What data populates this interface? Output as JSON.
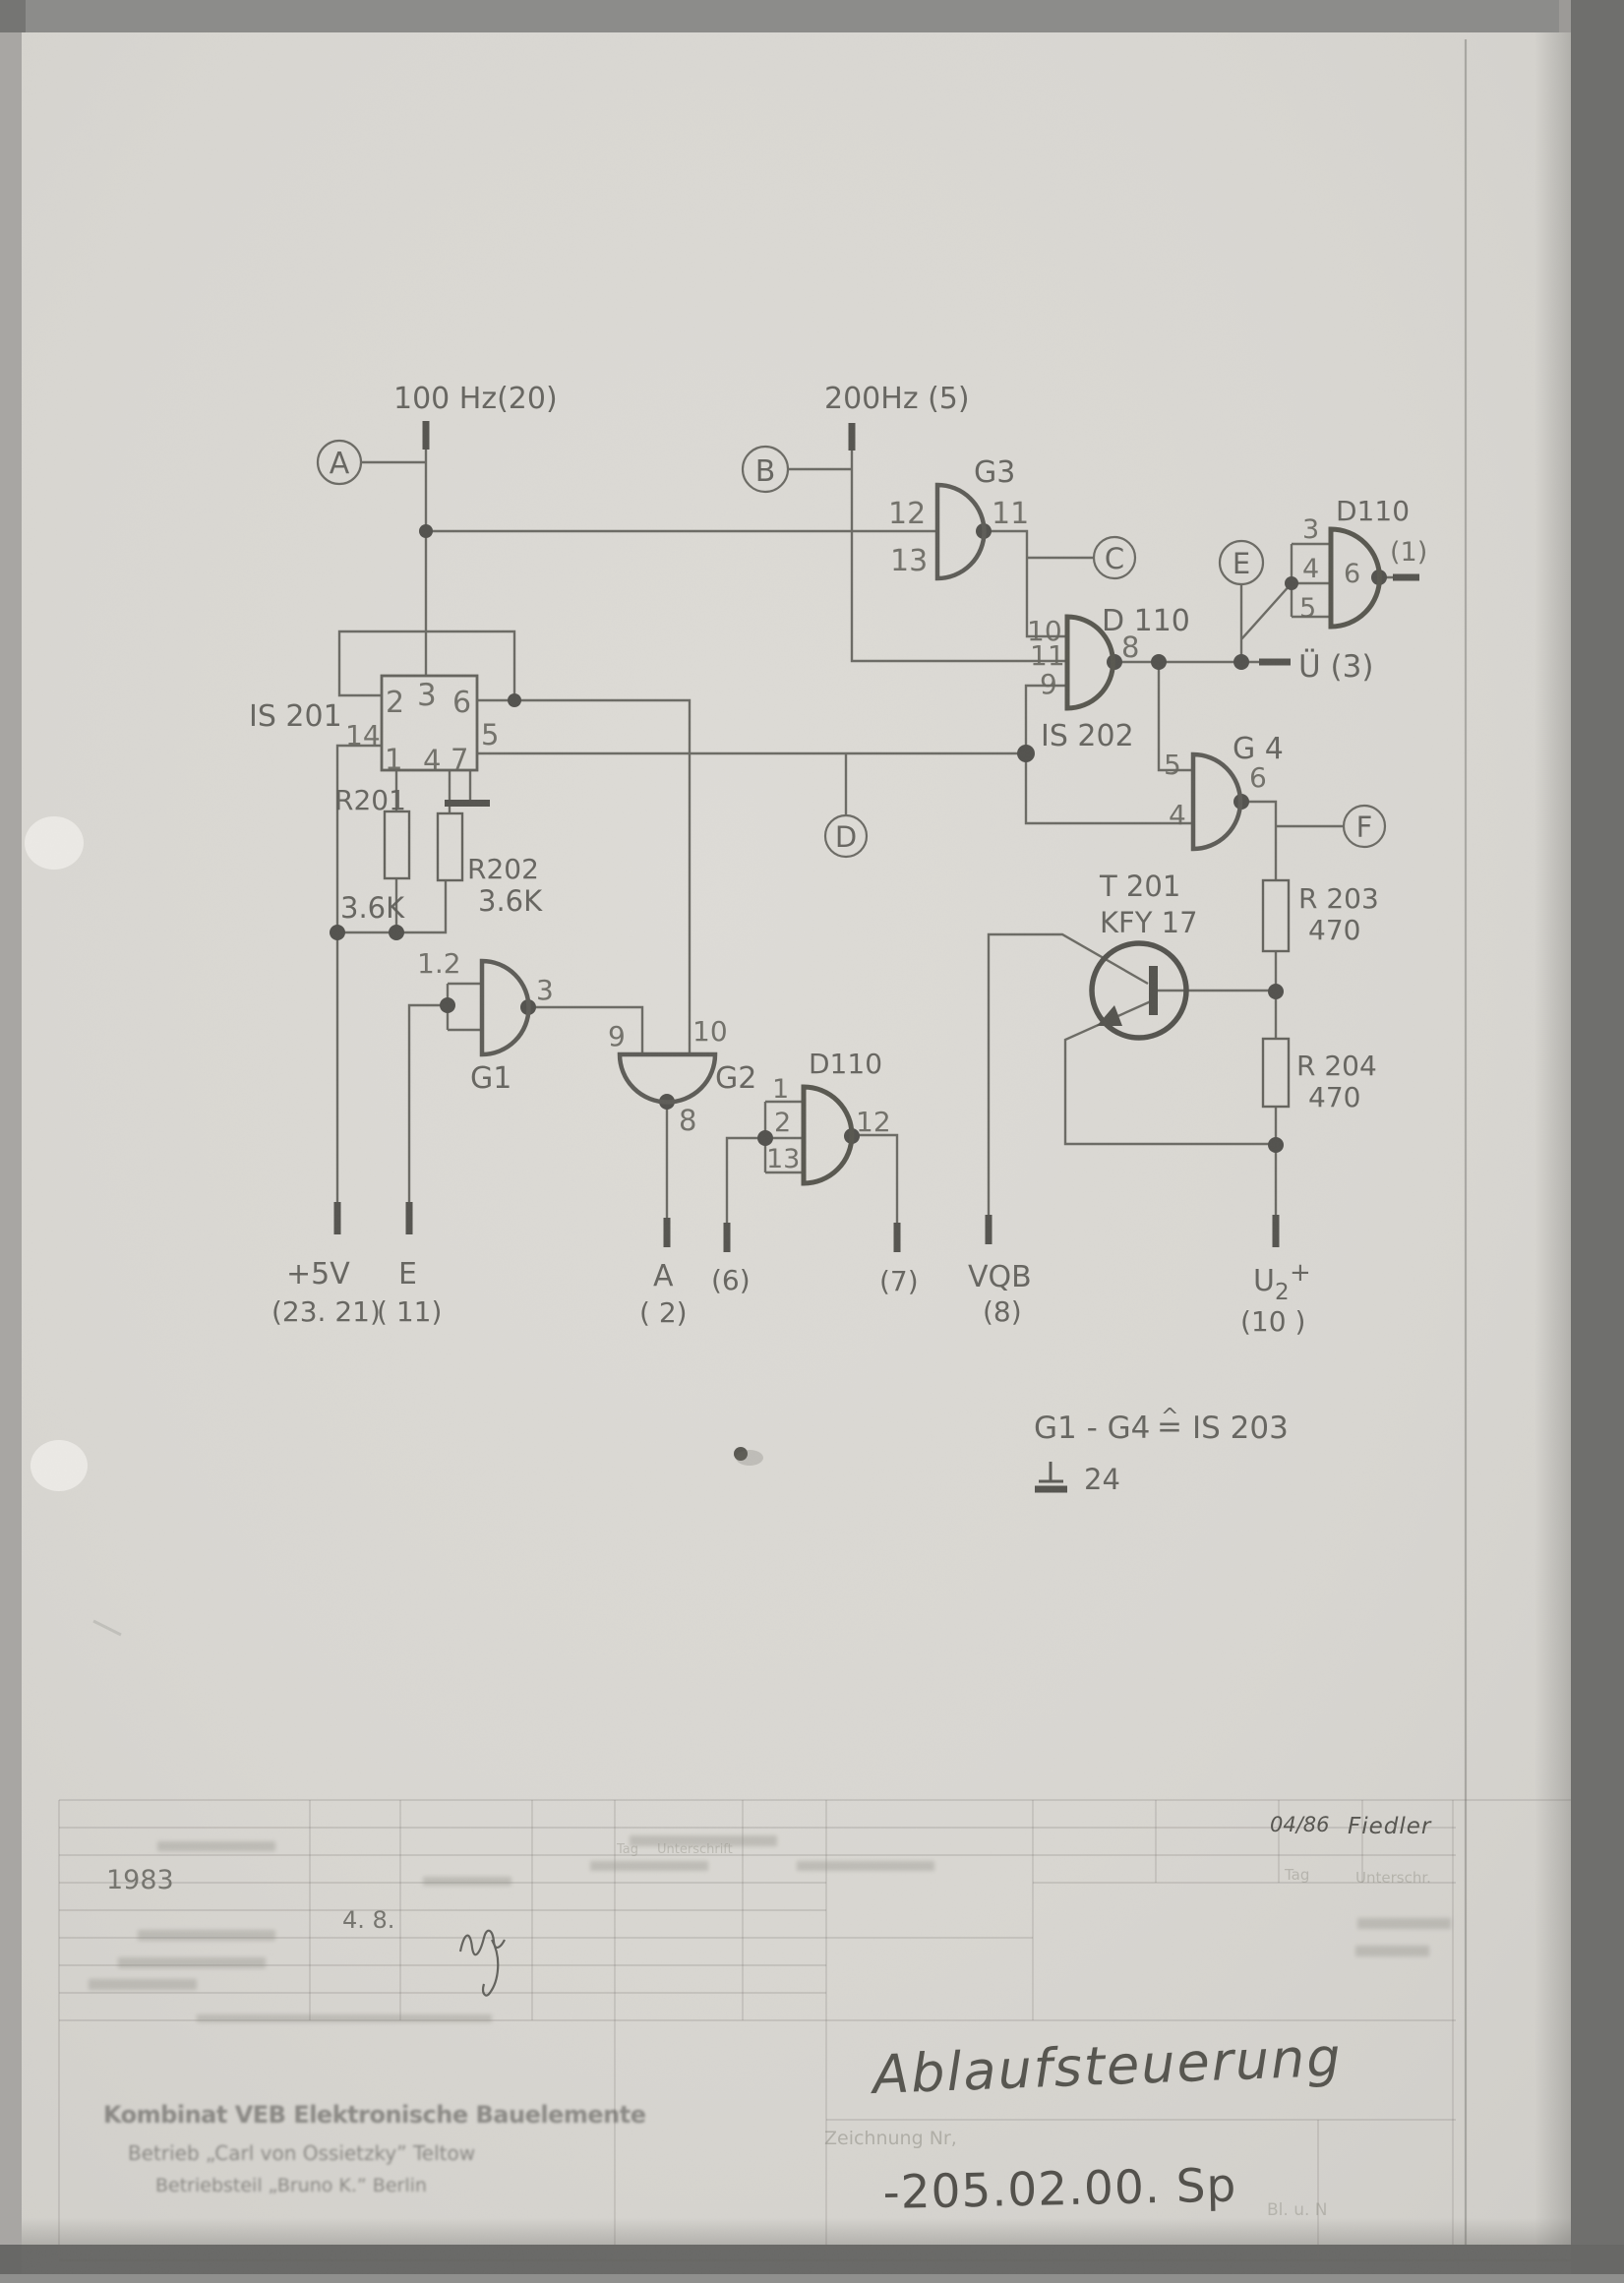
{
  "schematic": {
    "power": {
      "freq100": "100 Hz(20)",
      "freq200": "200Hz (5)"
    },
    "testpoints": {
      "a": "A",
      "b": "B",
      "c": "C",
      "d": "D",
      "e": "E",
      "f": "F"
    },
    "gates": {
      "g1": {
        "name": "G1",
        "in_tied": "1.2",
        "out_pin": "3"
      },
      "g2": {
        "name": "G2",
        "in_left": "9",
        "in_right": "10",
        "out_pin": "8"
      },
      "g3": {
        "name": "G3",
        "in_top": "12",
        "in_bottom": "13",
        "out_pin": "11"
      },
      "g4": {
        "name": "G 4",
        "in_top": "5",
        "in_bottom": "4",
        "out_pin": "6"
      }
    },
    "ics": {
      "is201": {
        "name": "IS 201",
        "p1": "1",
        "p2": "2",
        "p3": "3",
        "p4": "4",
        "p5": "5",
        "p6": "6",
        "p7": "7",
        "p14": "14"
      },
      "is202": {
        "name": "IS 202",
        "type": "D 110",
        "p8": "8",
        "p9": "9",
        "p10": "10",
        "p11": "11"
      },
      "d110_top": {
        "type": "D110",
        "p3": "3",
        "p4": "4",
        "p5": "5",
        "p6": "6",
        "out_label": "(1)"
      },
      "d110_bottom": {
        "type": "D110",
        "p1": "1",
        "p2": "2",
        "p12": "12",
        "p13": "13"
      }
    },
    "transistor": {
      "ref": "T 201",
      "part": "KFY 17"
    },
    "resistors": {
      "r201": {
        "ref": "R201",
        "value": "3.6K"
      },
      "r202": {
        "ref": "R202",
        "value": "3.6K"
      },
      "r203": {
        "ref": "R 203",
        "value": "470"
      },
      "r204": {
        "ref": "R 204",
        "value": "470"
      }
    },
    "terminals": {
      "plus5v": "+5V",
      "plus5v_pin": "(23. 21)",
      "e": "E",
      "e_pin": "( 11)",
      "a": "A",
      "a_pin": "( 2)",
      "t6": "(6)",
      "t7": "(7)",
      "vqb": "VQB",
      "vqb_pin": "(8)",
      "u2_base": "U",
      "u2_sub": "2",
      "u2_plus": "+",
      "u2_pin": "(10 )",
      "ue": "Ü (3)"
    },
    "note": {
      "range": "G1 - G4",
      "equals_ic": "IS 203",
      "gnd_pin": "24"
    }
  },
  "title_block": {
    "year": "1983",
    "date": "4. 8.",
    "approved_date": "04/86",
    "approved_name": "Fiedler",
    "col_tag_small": "Tag",
    "col_sign_small": "Unterschrift",
    "col_tag": "Tag",
    "col_sign": "Unterschr.",
    "drawing_no_label": "Zeichnung Nr,",
    "title": "Ablaufsteuerung",
    "drawing_no": "-205.02.00. Sp",
    "sheet_note": "Bl. u. N",
    "stamp": [
      "Kombinat VEB Elektronische Bauelemente",
      "Betrieb „Carl von Ossietzky” Teltow",
      "Betriebsteil  „Bruno K.”  Berlin"
    ]
  }
}
